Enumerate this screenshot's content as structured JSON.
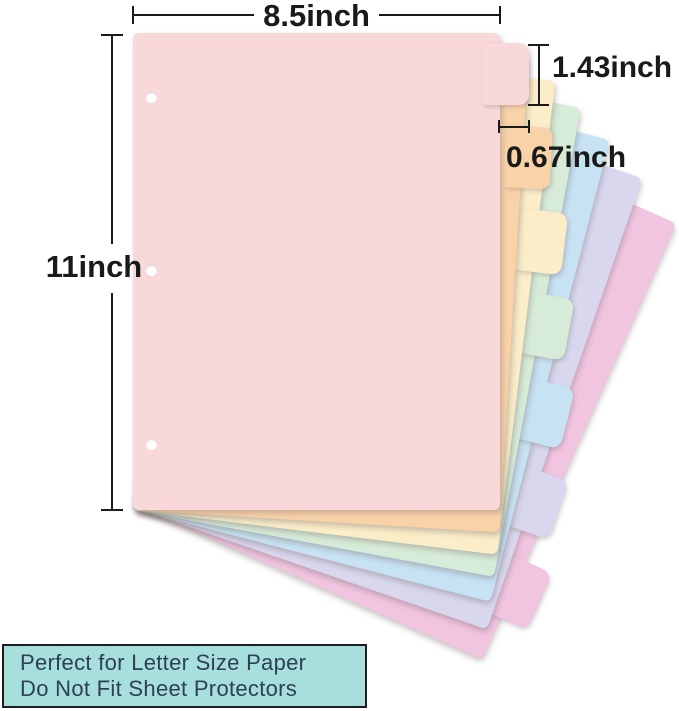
{
  "dimensions": {
    "width": "8.5inch",
    "height": "11inch",
    "tab_height": "1.43inch",
    "tab_depth": "0.67inch"
  },
  "divider_stack": {
    "sheet_count": 7,
    "sheets": [
      {
        "name": "pink",
        "color": "#f8d8d9"
      },
      {
        "name": "peach",
        "color": "#f9d2a8"
      },
      {
        "name": "cream",
        "color": "#faedc8"
      },
      {
        "name": "mint",
        "color": "#d6ecd8"
      },
      {
        "name": "blue",
        "color": "#c6e2f3"
      },
      {
        "name": "lavender",
        "color": "#d8d7ee"
      },
      {
        "name": "orchid",
        "color": "#f1c4e0"
      }
    ],
    "holes": {
      "count": 3,
      "color": "#ffffff"
    }
  },
  "annotations": {
    "color": "#1a1a1a"
  },
  "info_box": {
    "lines": [
      "Perfect for Letter Size Paper",
      "Do Not Fit Sheet Protectors"
    ],
    "background": "#a7dfdc",
    "border_color": "#1d1d1d",
    "text_color": "#2e4053"
  }
}
